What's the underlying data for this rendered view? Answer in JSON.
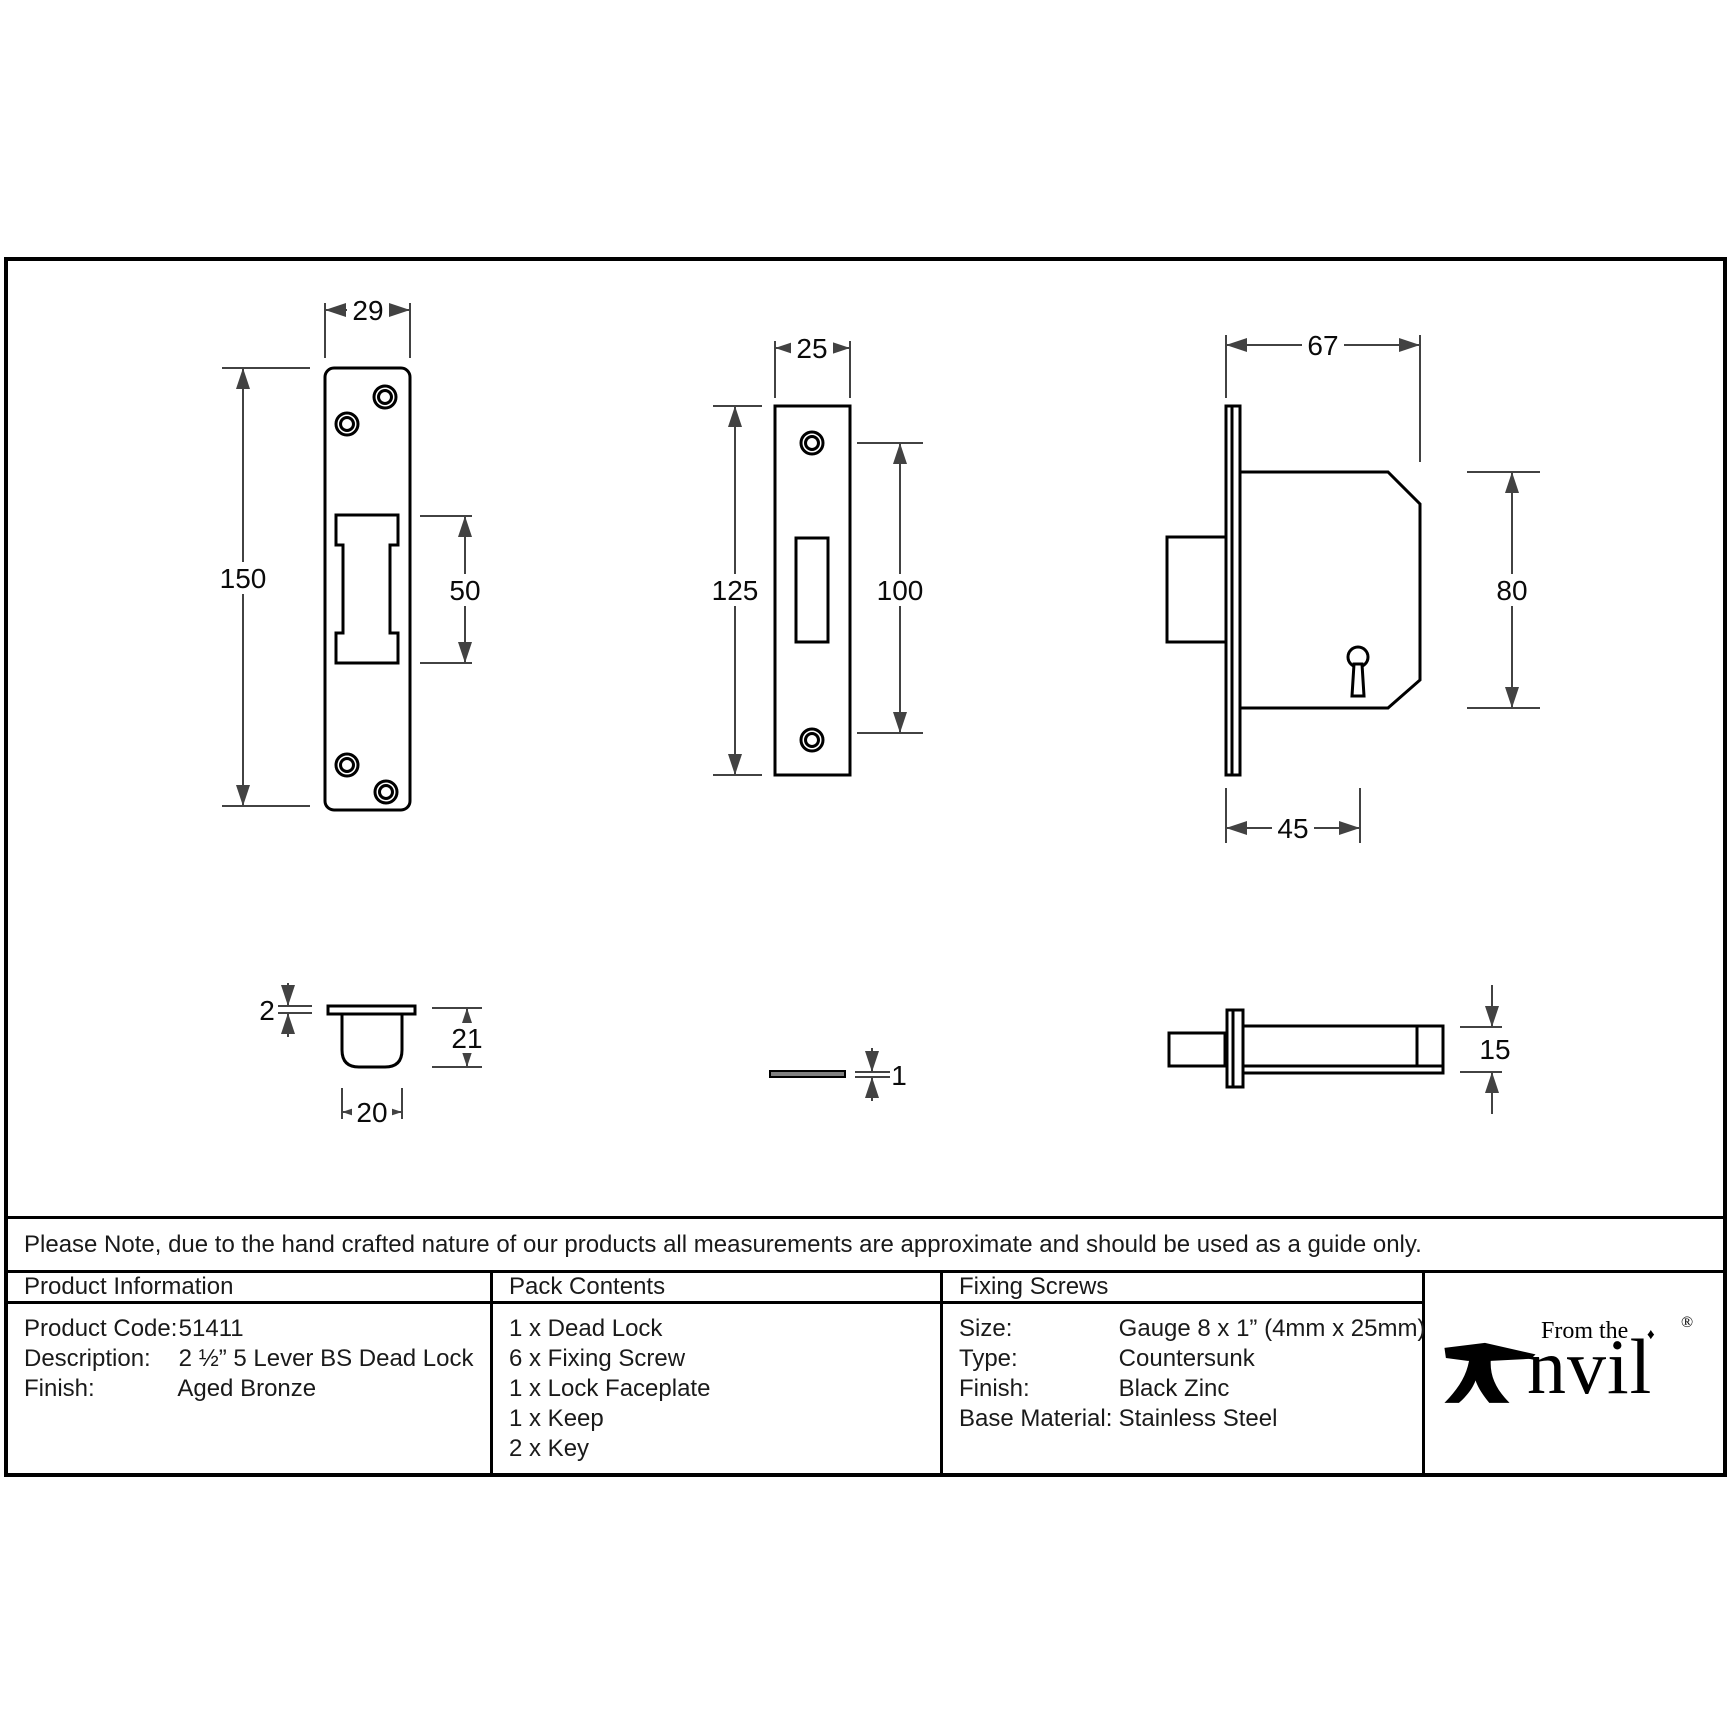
{
  "note": "Please Note, due to the hand crafted nature of our products all measurements are approximate and should be used as a guide only.",
  "colors": {
    "ink": "#000000",
    "dimension_line": "#424242"
  },
  "dimensions": {
    "lock_faceplate_front": {
      "width": "29",
      "height": "150",
      "slot_height": "50"
    },
    "keep_front": {
      "width": "25",
      "height": "125",
      "hole_spacing": "100"
    },
    "lock_body_side": {
      "case_width": "67",
      "case_height": "80",
      "backset": "45"
    },
    "keep_box_side": {
      "flange_thickness": "2",
      "depth": "21",
      "width": "20"
    },
    "faceplate_side": {
      "thickness": "1"
    },
    "bolt_side": {
      "height": "15"
    }
  },
  "table": {
    "product_information": {
      "title": "Product Information",
      "rows": [
        {
          "label": "Product Code:",
          "value": "51411"
        },
        {
          "label": "Description:",
          "value": "2 ½” 5 Lever BS Dead Lock"
        },
        {
          "label": "Finish:",
          "value": "Aged Bronze"
        }
      ]
    },
    "pack_contents": {
      "title": "Pack Contents",
      "items": [
        "1 x Dead Lock",
        "6 x Fixing Screw",
        "1 x Lock Faceplate",
        "1 x Keep",
        "2 x Key"
      ]
    },
    "fixing_screws": {
      "title": "Fixing Screws",
      "rows": [
        {
          "label": "Size:",
          "value": "Gauge 8 x 1” (4mm x 25mm)"
        },
        {
          "label": "Type:",
          "value": "Countersunk"
        },
        {
          "label": "Finish:",
          "value": "Black Zinc"
        },
        {
          "label": "Base Material:",
          "value": "Stainless Steel"
        }
      ]
    }
  },
  "logo": {
    "tagline": "From the",
    "diamond": "♦",
    "word": "nvil",
    "registered": "®"
  }
}
